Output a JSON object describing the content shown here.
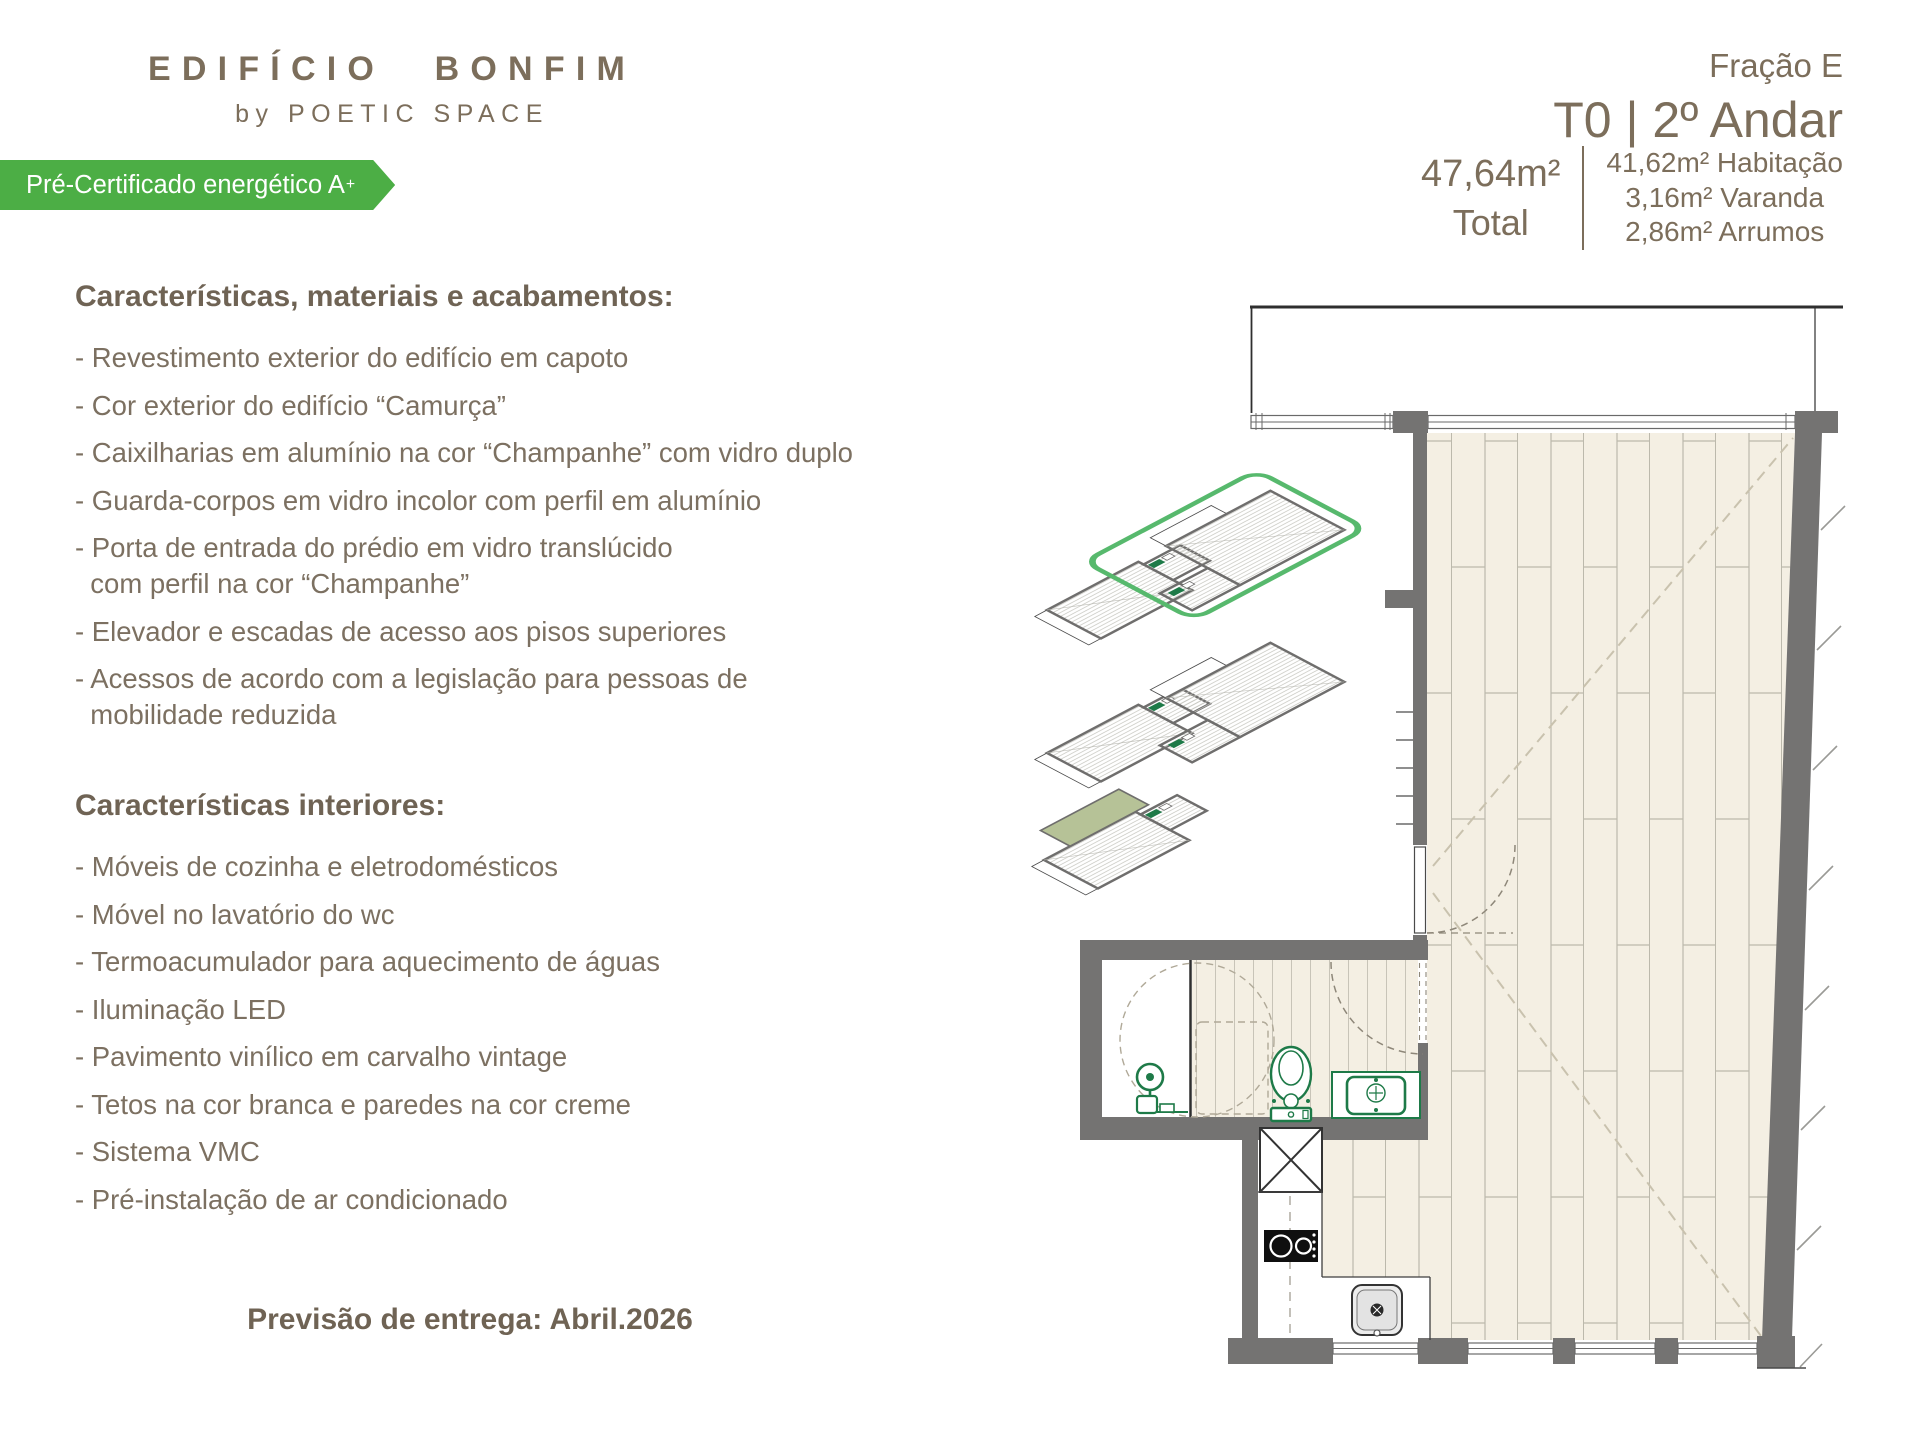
{
  "logo": {
    "title": "EDIFÍCIO BONFIM",
    "subtitle": "by POETIC SPACE"
  },
  "badge": {
    "label": "Pré-Certificado energético A",
    "sup": "+",
    "bg_color": "#4cae45"
  },
  "header": {
    "fraction": "Fração E",
    "typology": "T0 | 2º Andar",
    "total_value": "47,64m²",
    "total_label": "Total",
    "areas": [
      "41,62m² Habitação",
      "3,16m² Varanda",
      "2,86m² Arrumos"
    ]
  },
  "sections": [
    {
      "title": "Características, materiais e acabamentos:",
      "items": [
        "- Revestimento exterior do edifício em capoto",
        "- Cor exterior do edifício “Camurça”",
        "- Caixilharias em alumínio na cor “Champanhe” com vidro duplo",
        "- Guarda-corpos em vidro incolor com perfil em alumínio",
        "- Porta de entrada do prédio em vidro translúcido\n  com perfil na cor “Champanhe”",
        "- Elevador e escadas de acesso aos pisos superiores",
        "- Acessos de acordo com a legislação para pessoas de\n  mobilidade reduzida"
      ]
    },
    {
      "title": "Características interiores:",
      "items": [
        "- Móveis de cozinha e eletrodomésticos",
        "- Móvel no lavatório do wc",
        "- Termoacumulador para aquecimento de águas",
        "- Iluminação LED",
        "- Pavimento vinílico em carvalho vintage",
        "- Tetos na cor branca e paredes na cor creme",
        "- Sistema VMC",
        "- Pré-instalação de ar condicionado"
      ]
    }
  ],
  "delivery": {
    "text": "Previsão de entrega: Abril.2026"
  },
  "plan": {
    "colors": {
      "wall": "#747372",
      "floor": "#f4efe3",
      "fixtures_green": "#1e7a48",
      "highlight_green": "#57b96d",
      "terrace_green": "#b6c297",
      "text_brown": "#7c6e5b"
    },
    "axonometric_levels_shown": 3,
    "highlighted_unit": "top level right unit (green outline)"
  }
}
